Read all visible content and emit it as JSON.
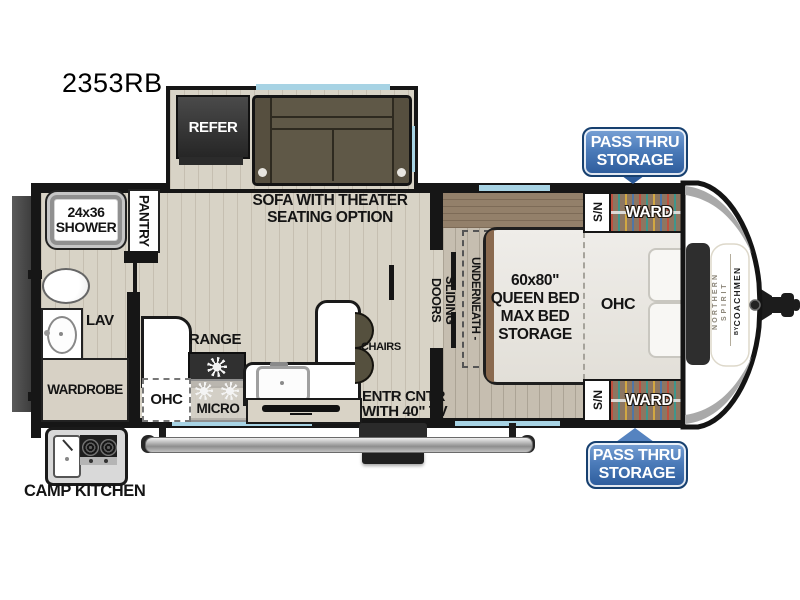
{
  "model_number": "2353RB",
  "living": {
    "refer": "REFER",
    "sofa_line1": "SOFA WITH THEATER",
    "sofa_line2": "SEATING OPTION",
    "chairs": "CHAIRS",
    "entr_line1": "ENTR CNTR",
    "entr_line2": "WITH 40\" TV"
  },
  "kitchen": {
    "range": "RANGE",
    "ohc": "OHC",
    "micro": "MICRO",
    "camp_kitchen": "CAMP KITCHEN"
  },
  "bath": {
    "shower_line1": "24x36",
    "shower_line2": "SHOWER",
    "pantry": "PANTRY",
    "lav": "LAV",
    "wardrobe": "WARDROBE"
  },
  "bedroom": {
    "sliding_doors": "SLIDING DOORS",
    "storage_underneath": "- STORAGE UNDERNEATH -",
    "bed_line1": "60x80\"",
    "bed_line2": "QUEEN BED",
    "bed_line3": "MAX BED",
    "bed_line4": "STORAGE",
    "ohc": "OHC",
    "ward": "WARD",
    "sn": "S/N"
  },
  "badges": {
    "pass_thru_line1": "PASS THRU",
    "pass_thru_line2": "STORAGE"
  },
  "brand": {
    "line1": "NORTHERN",
    "line2": "SPIRIT",
    "by": "BY",
    "name": "COACHMEN"
  },
  "colors": {
    "badge_blue": "#2c5b9b",
    "window_blue": "#a7d3e4",
    "wall_black": "#161616",
    "sofa_olive": "#5f5847",
    "floor_living": "#d8d3c6",
    "floor_bedroom": "#c6beb0",
    "ward_wood": "#8d7661",
    "front_cap_charcoal": "#2e2e2e"
  }
}
